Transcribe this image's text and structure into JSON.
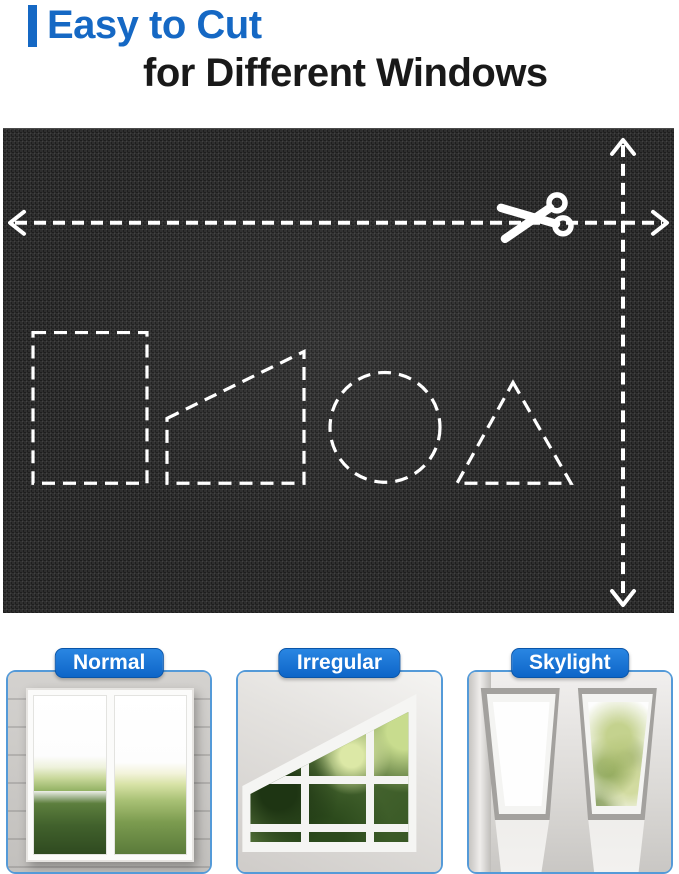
{
  "header": {
    "title_line1": "Easy to Cut",
    "title_line2": "for Different Windows"
  },
  "cut_diagram": {
    "fabric_color": "#2e2e2e",
    "guide_color": "#ffffff",
    "icons": [
      "scissors-icon",
      "horizontal-double-arrow",
      "vertical-double-arrow"
    ],
    "cut_shapes": [
      "rectangle",
      "trapezoid",
      "circle",
      "triangle"
    ]
  },
  "window_types": [
    {
      "label": "Normal"
    },
    {
      "label": "Irregular"
    },
    {
      "label": "Skylight"
    }
  ],
  "colors": {
    "accent_blue": "#1568c4",
    "badge_blue": "#0d65c8",
    "card_border_blue": "#549ad8",
    "title_text": "#191919"
  }
}
